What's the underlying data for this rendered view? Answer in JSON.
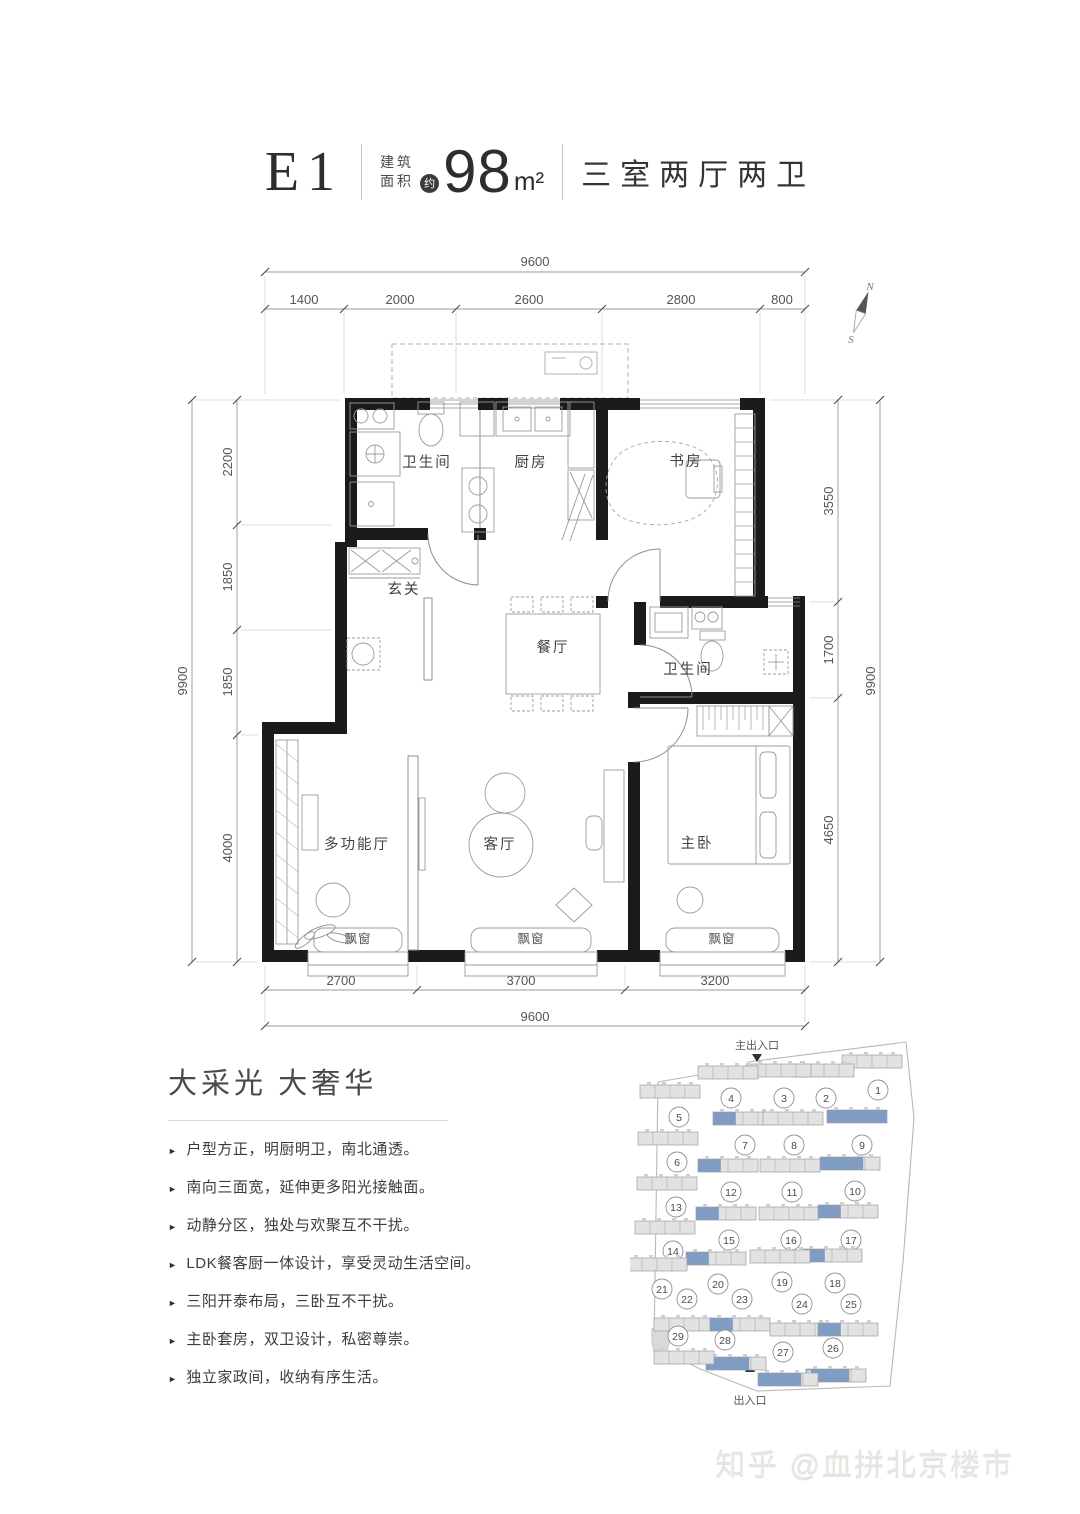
{
  "title": {
    "unit": "E1",
    "area_label_line1": "建筑",
    "area_label_line2": "面积",
    "approx": "约",
    "area_value": "98",
    "area_unit": "m²",
    "layout": "三室两厅两卫"
  },
  "compass": {
    "north": "N",
    "south": "S"
  },
  "dimensions": {
    "top": {
      "total": "9600",
      "segments": [
        "1400",
        "2000",
        "2600",
        "2800",
        "800"
      ]
    },
    "bottom": {
      "total": "9600",
      "segments": [
        "2700",
        "3700",
        "3200"
      ]
    },
    "left": {
      "total": "9900",
      "segments": [
        "2200",
        "1850",
        "1850",
        "4000"
      ]
    },
    "right": {
      "total": "9900",
      "segments": [
        "3550",
        "1700",
        "4650"
      ]
    }
  },
  "rooms": {
    "bath1": "卫生间",
    "kitchen": "厨房",
    "study": "书房",
    "foyer": "玄关",
    "dining": "餐厅",
    "bath2": "卫生间",
    "multi": "多功能厅",
    "living": "客厅",
    "master": "主卧",
    "bay1": "飘窗",
    "bay2": "飘窗",
    "bay3": "飘窗"
  },
  "features": {
    "title": "大采光 大奢华",
    "marker": "►",
    "bullets": [
      "户型方正，明厨明卫，南北通透。",
      "南向三面宽，延伸更多阳光接触面。",
      "动静分区，独处与欢聚互不干扰。",
      "LDK餐客厨一体设计，享受灵动生活空间。",
      "三阳开泰布局，三卧互不干扰。",
      "主卧套房，双卫设计，私密尊崇。",
      "独立家政间，收纳有序生活。"
    ]
  },
  "siteplan": {
    "main_entrance": "主出入口",
    "entrance": "出入口",
    "highlight_color": "#7f9cc4",
    "buildings": [
      {
        "n": "1",
        "cx": 878,
        "cy": 1090,
        "sx": 872,
        "sy": 1062,
        "hl": "none"
      },
      {
        "n": "2",
        "cx": 826,
        "cy": 1098,
        "sx": 824,
        "sy": 1071,
        "hl": "none"
      },
      {
        "n": "3",
        "cx": 784,
        "cy": 1098,
        "sx": 781,
        "sy": 1071,
        "hl": "none"
      },
      {
        "n": "4",
        "cx": 731,
        "cy": 1098,
        "sx": 728,
        "sy": 1073,
        "hl": "none"
      },
      {
        "n": "5",
        "cx": 679,
        "cy": 1117,
        "sx": 670,
        "sy": 1092,
        "hl": "none"
      },
      {
        "n": "6",
        "cx": 677,
        "cy": 1162,
        "sx": 668,
        "sy": 1139,
        "hl": "none"
      },
      {
        "n": "7",
        "cx": 745,
        "cy": 1145,
        "sx": 743,
        "sy": 1119,
        "hl": "part"
      },
      {
        "n": "8",
        "cx": 794,
        "cy": 1145,
        "sx": 793,
        "sy": 1119,
        "hl": "none"
      },
      {
        "n": "9",
        "cx": 862,
        "cy": 1145,
        "sx": 857,
        "sy": 1117,
        "hl": "full"
      },
      {
        "n": "10",
        "cx": 855,
        "cy": 1191,
        "sx": 850,
        "sy": 1164,
        "hl": "most"
      },
      {
        "n": "11",
        "cx": 792,
        "cy": 1192,
        "sx": 790,
        "sy": 1166,
        "hl": "none"
      },
      {
        "n": "12",
        "cx": 731,
        "cy": 1192,
        "sx": 728,
        "sy": 1166,
        "hl": "part"
      },
      {
        "n": "13",
        "cx": 676,
        "cy": 1207,
        "sx": 667,
        "sy": 1184,
        "hl": "none"
      },
      {
        "n": "14",
        "cx": 673,
        "cy": 1251,
        "sx": 665,
        "sy": 1228,
        "hl": "none"
      },
      {
        "n": "15",
        "cx": 729,
        "cy": 1240,
        "sx": 726,
        "sy": 1214,
        "hl": "part"
      },
      {
        "n": "16",
        "cx": 791,
        "cy": 1240,
        "sx": 789,
        "sy": 1214,
        "hl": "none"
      },
      {
        "n": "17",
        "cx": 851,
        "cy": 1240,
        "sx": 848,
        "sy": 1212,
        "hl": "part"
      },
      {
        "n": "18",
        "cx": 835,
        "cy": 1283,
        "sx": 832,
        "sy": 1256,
        "hl": "part"
      },
      {
        "n": "19",
        "cx": 782,
        "cy": 1282,
        "sx": 780,
        "sy": 1257,
        "hl": "none"
      },
      {
        "n": "20",
        "cx": 718,
        "cy": 1284,
        "sx": 716,
        "sy": 1259,
        "hl": "part"
      },
      {
        "n": "21",
        "cx": 662,
        "cy": 1289,
        "sx": 657,
        "sy": 1265,
        "hl": "none"
      },
      {
        "n": "22",
        "cx": 687,
        "cy": 1299,
        "sx": 684,
        "sy": 1325,
        "hl": "none"
      },
      {
        "n": "23",
        "cx": 742,
        "cy": 1299,
        "sx": 740,
        "sy": 1325,
        "hl": "part"
      },
      {
        "n": "24",
        "cx": 802,
        "cy": 1304,
        "sx": 800,
        "sy": 1330,
        "hl": "none"
      },
      {
        "n": "25",
        "cx": 851,
        "cy": 1304,
        "sx": 848,
        "sy": 1330,
        "hl": "part"
      },
      {
        "n": "26",
        "cx": 833,
        "cy": 1348,
        "sx": 836,
        "sy": 1376,
        "hl": "most"
      },
      {
        "n": "27",
        "cx": 783,
        "cy": 1352,
        "sx": 788,
        "sy": 1380,
        "hl": "most"
      },
      {
        "n": "28",
        "cx": 725,
        "cy": 1340,
        "sx": 736,
        "sy": 1364,
        "hl": "most"
      },
      {
        "n": "29",
        "cx": 678,
        "cy": 1336,
        "sx": 684,
        "sy": 1358,
        "hl": "none"
      }
    ]
  },
  "watermark": "知乎 @血拼北京楼市"
}
